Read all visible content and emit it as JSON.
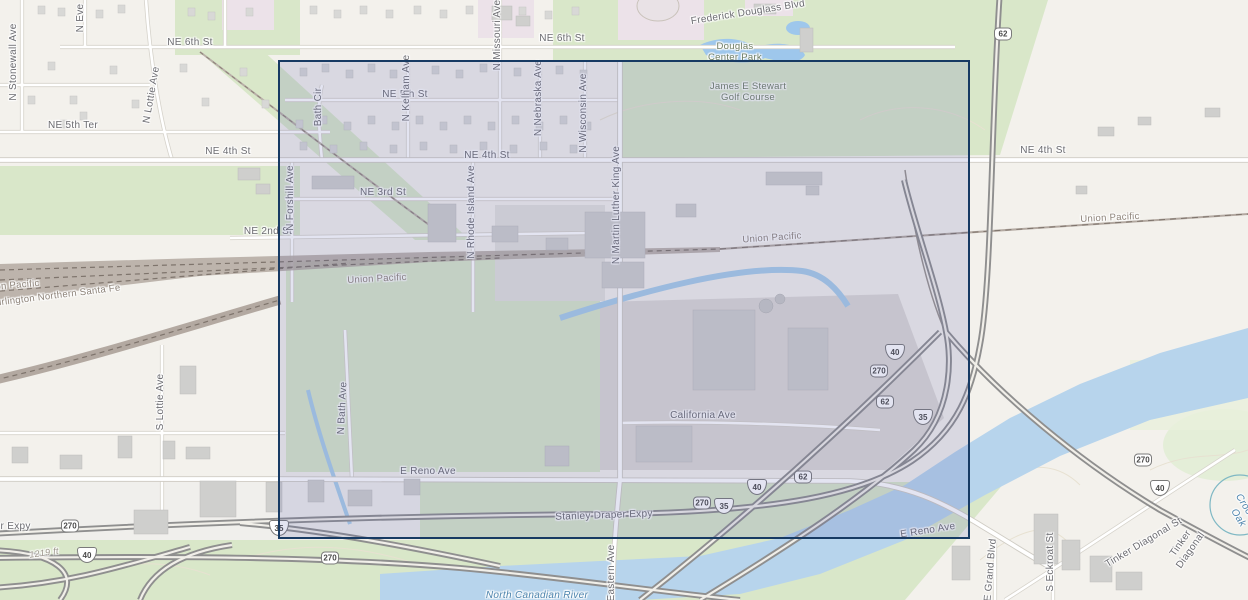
{
  "map": {
    "description": "Street basemap, northeast Oklahoma City area, with rectangular extent selection",
    "labels": [
      {
        "text": "N Stonewall Ave",
        "x": 14,
        "y": 62,
        "rot": -90,
        "cls": "street"
      },
      {
        "text": "N Eve",
        "x": 81,
        "y": 18,
        "rot": -90,
        "cls": "street"
      },
      {
        "text": "N Lottie Ave",
        "x": 152,
        "y": 95,
        "rot": -80,
        "cls": "street"
      },
      {
        "text": "NE 6th St",
        "x": 190,
        "y": 43,
        "rot": 0,
        "cls": "street"
      },
      {
        "text": "NE 6th St",
        "x": 562,
        "y": 39,
        "rot": 0,
        "cls": "street"
      },
      {
        "text": "NE 5th Ter",
        "x": 73,
        "y": 126,
        "rot": 0,
        "cls": "street"
      },
      {
        "text": "NE 5th St",
        "x": 405,
        "y": 95,
        "rot": 0,
        "cls": "street"
      },
      {
        "text": "NE 4th St",
        "x": 228,
        "y": 152,
        "rot": 0,
        "cls": "street"
      },
      {
        "text": "NE 4th St",
        "x": 487,
        "y": 156,
        "rot": 0,
        "cls": "street"
      },
      {
        "text": "NE 4th St",
        "x": 1043,
        "y": 151,
        "rot": 0,
        "cls": "street"
      },
      {
        "text": "NE 3rd St",
        "x": 383,
        "y": 193,
        "rot": 0,
        "cls": "street"
      },
      {
        "text": "NE 2nd St",
        "x": 268,
        "y": 232,
        "rot": 0,
        "cls": "street"
      },
      {
        "text": "N Kelham Ave",
        "x": 407,
        "y": 88,
        "rot": -90,
        "cls": "street"
      },
      {
        "text": "N Missouri Ave",
        "x": 498,
        "y": 35,
        "rot": -90,
        "cls": "street"
      },
      {
        "text": "N Nebraska Ave",
        "x": 539,
        "y": 98,
        "rot": -90,
        "cls": "street"
      },
      {
        "text": "N Wisconsin Ave",
        "x": 584,
        "y": 113,
        "rot": -90,
        "cls": "street"
      },
      {
        "text": "Bath Cir",
        "x": 319,
        "y": 107,
        "rot": -90,
        "cls": "street"
      },
      {
        "text": "N Forshill Ave",
        "x": 291,
        "y": 198,
        "rot": -90,
        "cls": "street"
      },
      {
        "text": "N Rhode Island Ave",
        "x": 472,
        "y": 212,
        "rot": -90,
        "cls": "street"
      },
      {
        "text": "N Martin Luther King Ave",
        "x": 617,
        "y": 205,
        "rot": -90,
        "cls": "street"
      },
      {
        "text": "N Bath Ave",
        "x": 343,
        "y": 408,
        "rot": -87,
        "cls": "street"
      },
      {
        "text": "S Lottie Ave",
        "x": 161,
        "y": 402,
        "rot": -90,
        "cls": "street"
      },
      {
        "text": "Frederick Douglass Blvd",
        "x": 748,
        "y": 13,
        "rot": -9,
        "cls": "street"
      },
      {
        "text": "Douglas\nCenter Park",
        "x": 735,
        "y": 52,
        "rot": 0,
        "cls": "park"
      },
      {
        "text": "James E Stewart\nGolf Course",
        "x": 748,
        "y": 92,
        "rot": 0,
        "cls": "park"
      },
      {
        "text": "California Ave",
        "x": 703,
        "y": 416,
        "rot": 0,
        "cls": "street"
      },
      {
        "text": "E Reno Ave",
        "x": 428,
        "y": 472,
        "rot": 0,
        "cls": "street"
      },
      {
        "text": "E Reno Ave",
        "x": 928,
        "y": 531,
        "rot": -9,
        "cls": "street"
      },
      {
        "text": "Stanley Draper Expy",
        "x": 604,
        "y": 516,
        "rot": -2,
        "cls": "street"
      },
      {
        "text": "Stanley Draper Expy",
        "x": -18,
        "y": 527,
        "rot": 0,
        "cls": "street"
      },
      {
        "text": "1219 ft",
        "x": 44,
        "y": 553,
        "rot": -8,
        "cls": "elev"
      },
      {
        "text": "Eastern Ave",
        "x": 612,
        "y": 573,
        "rot": -90,
        "cls": "street"
      },
      {
        "text": "North Canadian River",
        "x": 537,
        "y": 596,
        "rot": 0,
        "cls": "water"
      },
      {
        "text": "E Grand Blvd",
        "x": 991,
        "y": 570,
        "rot": -85,
        "cls": "street"
      },
      {
        "text": "S Eckroat St",
        "x": 1051,
        "y": 562,
        "rot": -90,
        "cls": "street"
      },
      {
        "text": "Tinker Diagonal St",
        "x": 1144,
        "y": 543,
        "rot": -31,
        "cls": "street"
      },
      {
        "text": "Tinker Diagonal",
        "x": 1186,
        "y": 547,
        "rot": -55,
        "cls": "street"
      },
      {
        "text": "Union Pacific",
        "x": 377,
        "y": 279,
        "rot": -3,
        "cls": "rail"
      },
      {
        "text": "Union Pacific",
        "x": 772,
        "y": 238,
        "rot": -4,
        "cls": "rail"
      },
      {
        "text": "Union Pacific",
        "x": 1110,
        "y": 218,
        "rot": -3,
        "cls": "rail"
      },
      {
        "text": "Union Pacific",
        "x": 10,
        "y": 286,
        "rot": -5,
        "cls": "rail"
      },
      {
        "text": "Burlington Northern Santa Fe",
        "x": 55,
        "y": 296,
        "rot": -7,
        "cls": "rail"
      },
      {
        "text": "Crooked Oak",
        "x": 1243,
        "y": 515,
        "rot": 58,
        "cls": "water"
      }
    ],
    "shields": [
      {
        "type": "us",
        "num": "62",
        "x": 1003,
        "y": 34
      },
      {
        "type": "i",
        "num": "40",
        "x": 895,
        "y": 352
      },
      {
        "type": "us",
        "num": "270",
        "x": 879,
        "y": 371
      },
      {
        "type": "us",
        "num": "62",
        "x": 885,
        "y": 402
      },
      {
        "type": "i",
        "num": "35",
        "x": 923,
        "y": 417
      },
      {
        "type": "i",
        "num": "40",
        "x": 757,
        "y": 487
      },
      {
        "type": "us",
        "num": "62",
        "x": 803,
        "y": 477
      },
      {
        "type": "us",
        "num": "270",
        "x": 702,
        "y": 503
      },
      {
        "type": "i",
        "num": "35",
        "x": 724,
        "y": 506
      },
      {
        "type": "us",
        "num": "270",
        "x": 70,
        "y": 526
      },
      {
        "type": "i",
        "num": "35",
        "x": 279,
        "y": 528
      },
      {
        "type": "i",
        "num": "40",
        "x": 87,
        "y": 555
      },
      {
        "type": "us",
        "num": "270",
        "x": 330,
        "y": 558
      },
      {
        "type": "us",
        "num": "270",
        "x": 1143,
        "y": 460
      },
      {
        "type": "i",
        "num": "40",
        "x": 1160,
        "y": 488
      }
    ]
  },
  "selection": {
    "x": 278,
    "y": 60,
    "width": 692,
    "height": 479,
    "border_color": "#173a63",
    "fill_color": "rgba(88,96,172,0.17)"
  },
  "colors": {
    "background": "#f3f1ec",
    "park_green": "#d9e7c9",
    "water_blue": "#b7d4ec",
    "campus_pink": "#ece2e9",
    "building_gray": "#d8d8d6",
    "freeway_gray": "#8f8f8f",
    "rail_brown": "#b3a9a1"
  }
}
